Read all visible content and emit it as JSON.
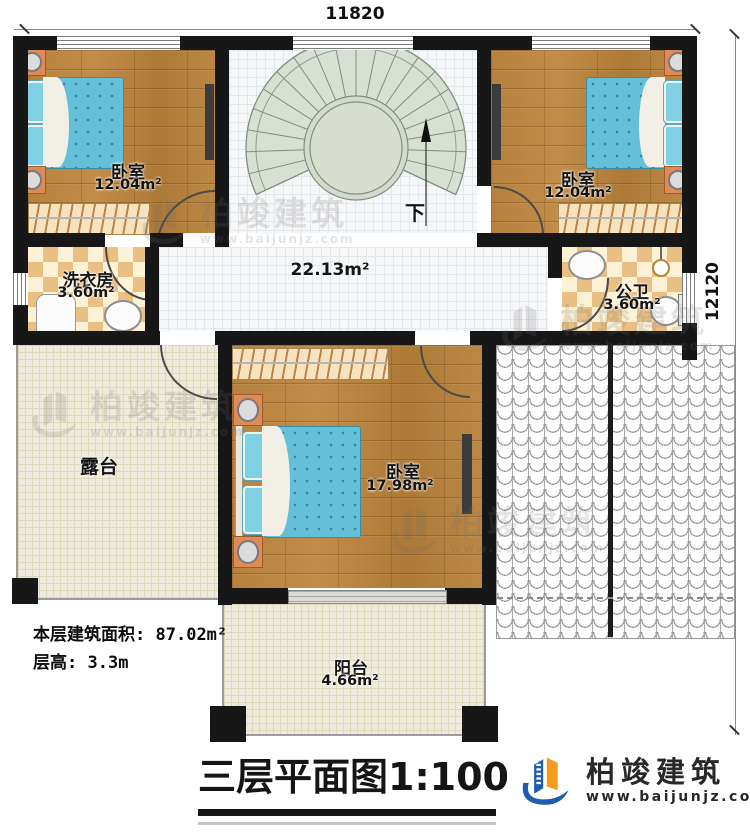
{
  "dimensions": {
    "width_label": "11820",
    "height_label": "12120"
  },
  "rooms": {
    "bedroom_tl": {
      "name": "卧室",
      "area": "12.04m²"
    },
    "bedroom_tr": {
      "name": "卧室",
      "area": "12.04m²"
    },
    "laundry": {
      "name": "洗衣房",
      "area": "3.60m²"
    },
    "bathroom": {
      "name": "公卫",
      "area": "3.60m²"
    },
    "hall": {
      "area": "22.13m²"
    },
    "terrace": {
      "name": "露台"
    },
    "bedroom_main": {
      "name": "卧室",
      "area": "17.98m²"
    },
    "balcony": {
      "name": "阳台",
      "area": "4.66m²"
    }
  },
  "stair": {
    "down": "下"
  },
  "notes": {
    "area_label": "本层建筑面积:",
    "area_value": "87.02m²",
    "height_label": "层高:",
    "height_value": "3.3m"
  },
  "title": {
    "name": "三层平面图",
    "scale": "1:100"
  },
  "brand": {
    "name": "柏竣建筑",
    "url": "www.baijunjz.com"
  },
  "watermark": {
    "name": "柏竣建筑",
    "url": "www.baijunjz.com"
  },
  "colors": {
    "wall": "#171717",
    "wood_floor": "#b5813d",
    "tile_floor": "#f6f7f8",
    "checker_tile": "#e9bf83",
    "stair": "#d8dfd3",
    "terrace_floor": "#eeebdc",
    "mattress": "#64c0d8",
    "nightstand": "#e08b57",
    "brand_blue": "#1d5dad",
    "brand_orange": "#f29b1d"
  }
}
